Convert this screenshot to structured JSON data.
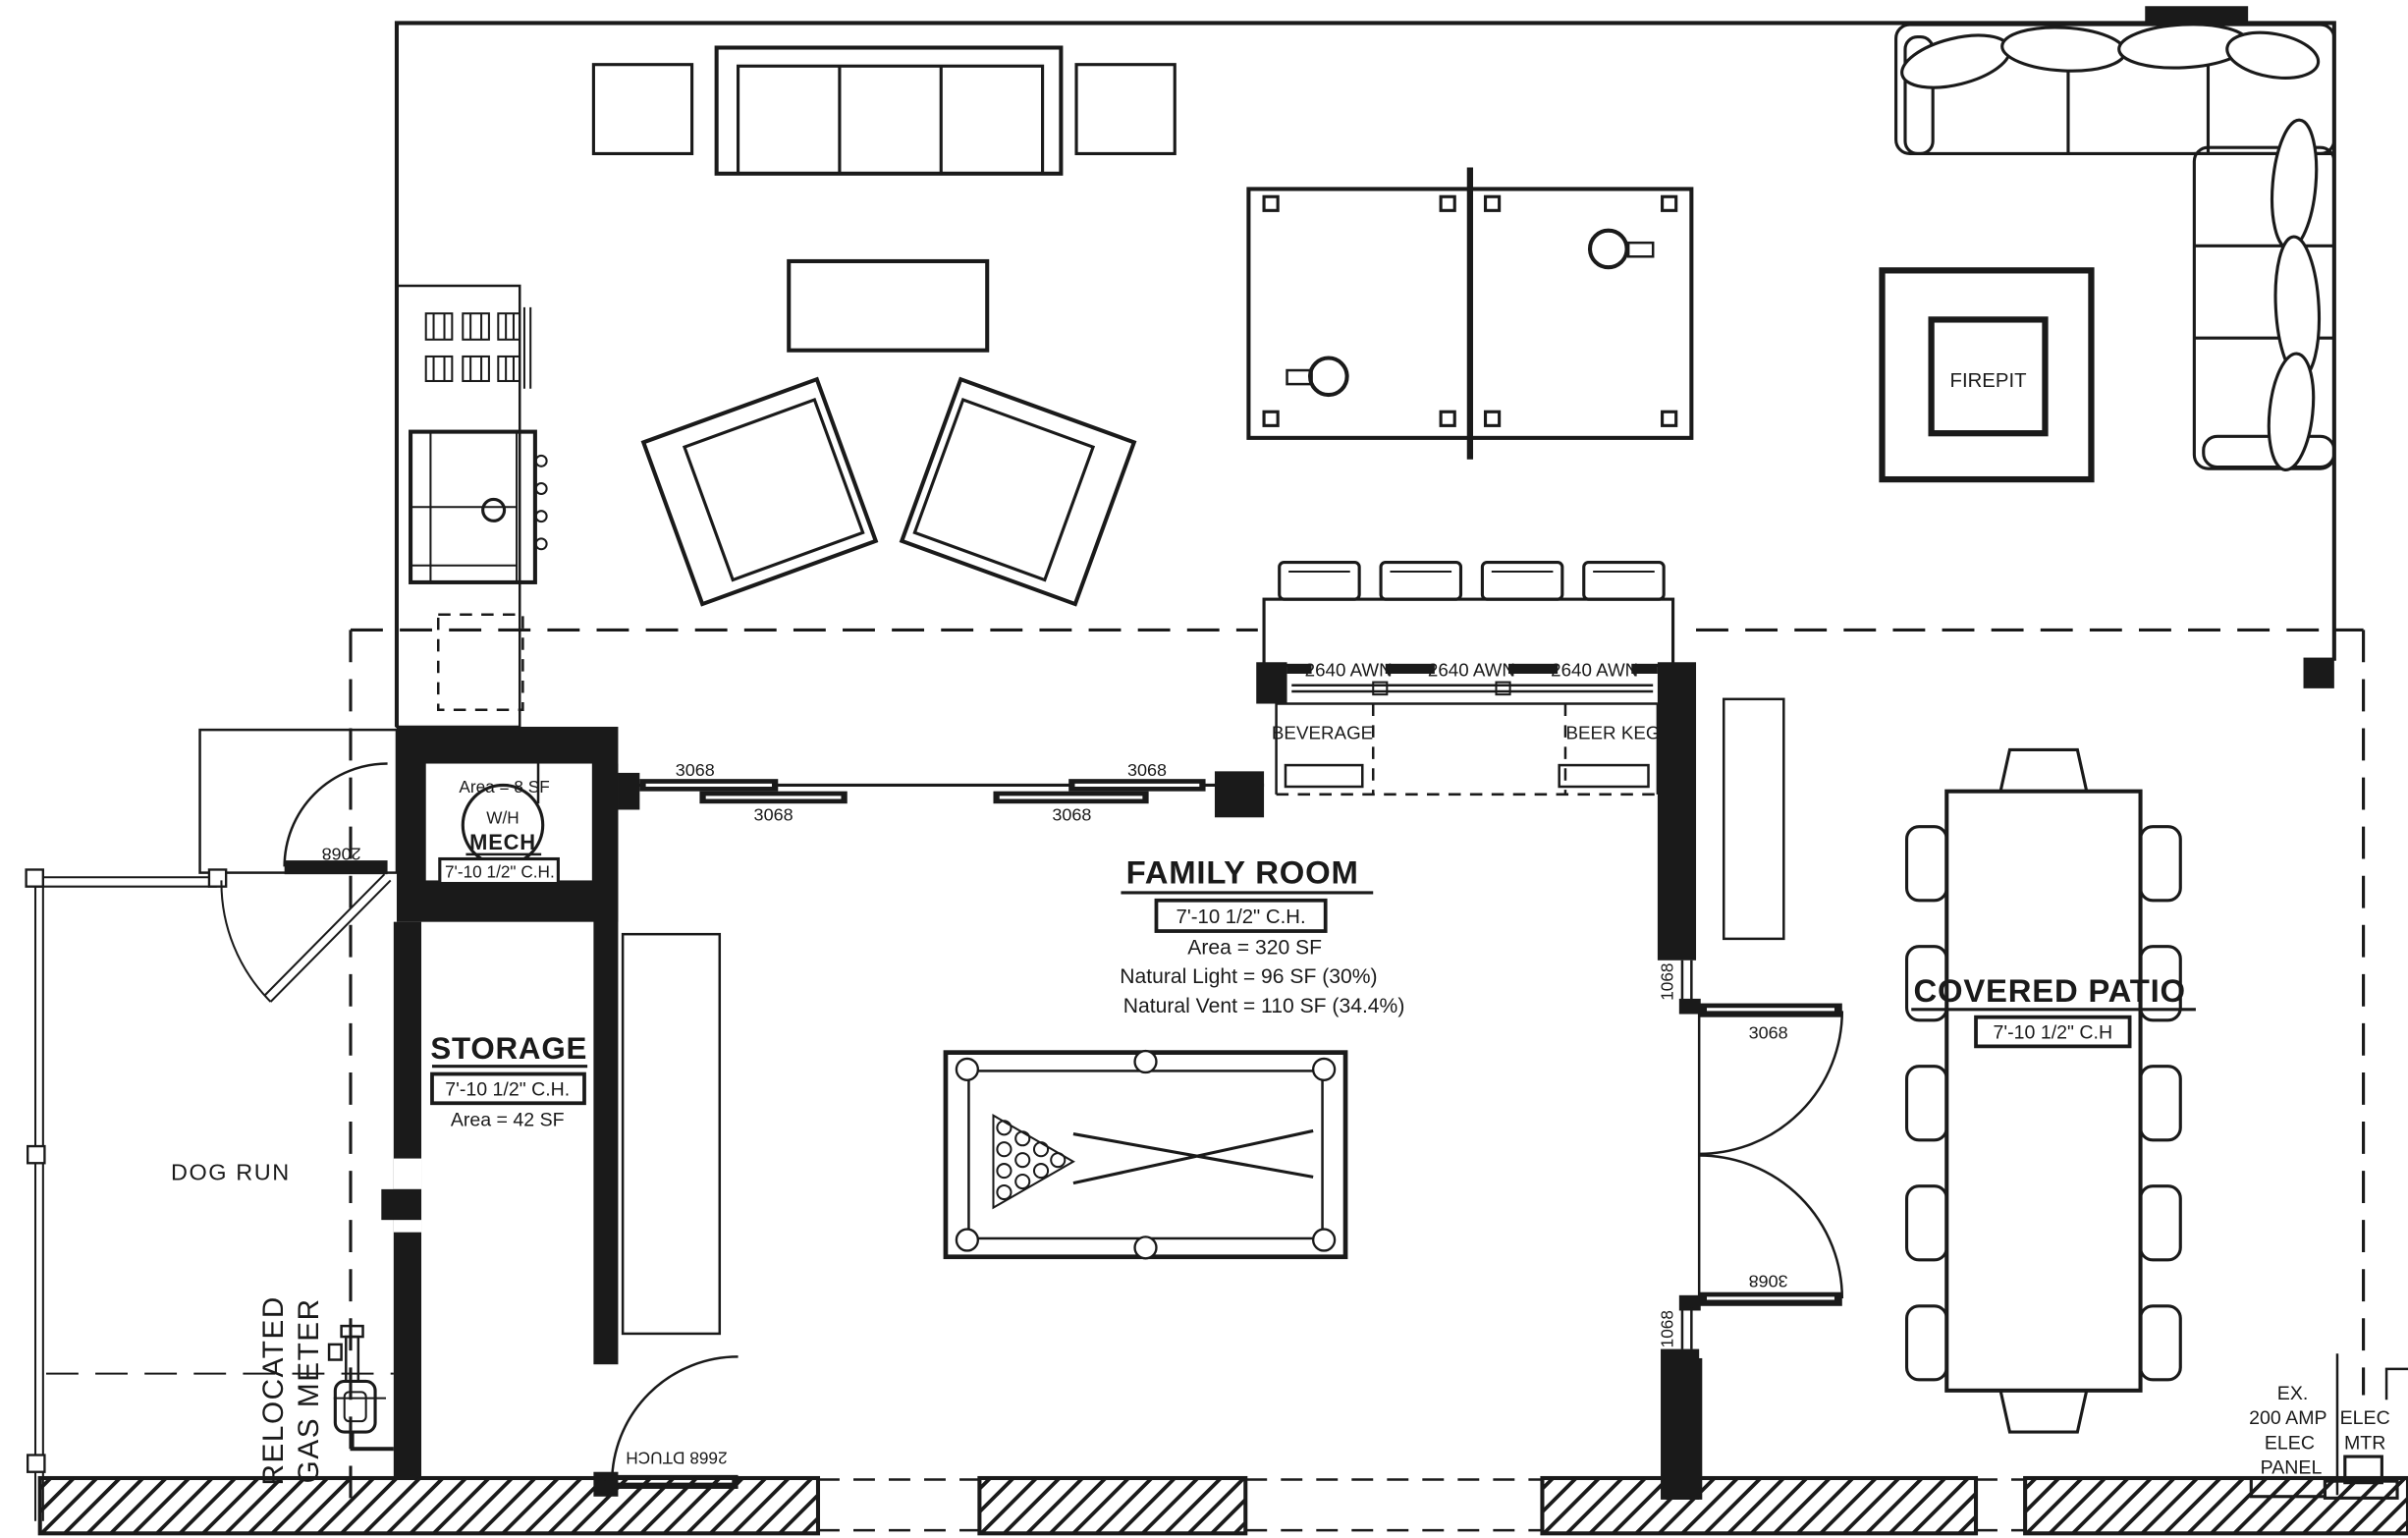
{
  "colors": {
    "ink": "#1a1a1a",
    "paper": "#ffffff"
  },
  "rooms": {
    "mech": {
      "name": "MECH",
      "fixture": "W/H",
      "area": "Area  =  8 SF",
      "ceiling": "7'-10 1/2\" C.H."
    },
    "storage": {
      "name": "STORAGE",
      "ceiling": "7'-10 1/2\" C.H.",
      "area": "Area  =  42 SF"
    },
    "family_room": {
      "name": "FAMILY ROOM",
      "ceiling": "7'-10 1/2\" C.H.",
      "area": "Area  =  320 SF",
      "natural_light": "Natural Light =  96 SF (30%)",
      "natural_vent": "Natural Vent =  110 SF (34.4%)"
    },
    "covered_patio": {
      "name": "COVERED PATIO",
      "ceiling": "7'-10 1/2\" C.H"
    },
    "dog_run": {
      "name": "DOG RUN"
    },
    "firepit": {
      "name": "FIREPIT"
    }
  },
  "fixtures": {
    "beverage": "BEVERAGE",
    "beer_keg": "BEER KEG"
  },
  "windows": {
    "awning": "2640 AWN",
    "sidelight": "1068"
  },
  "doors": {
    "mech_entry": "2068",
    "slider": "3068",
    "french": "3068",
    "dutch": "2668 DTUCH"
  },
  "annotations": {
    "gas_meter_line1": "RELOCATED",
    "gas_meter_line2": "GAS METER",
    "elec_panel": [
      "EX.",
      "200 AMP",
      "ELEC",
      "PANEL"
    ],
    "elec_meter": [
      "ELEC",
      "MTR"
    ]
  }
}
